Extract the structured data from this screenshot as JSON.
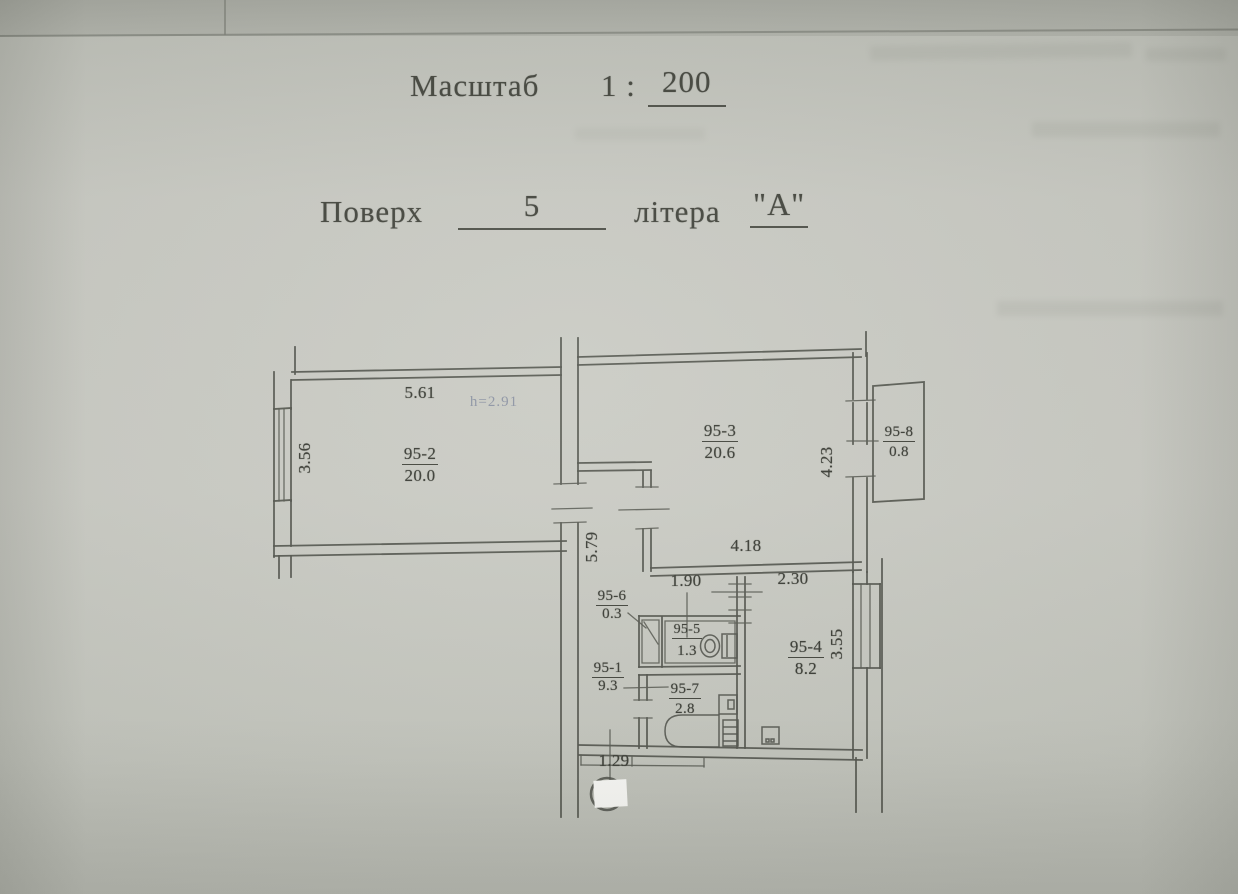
{
  "header": {
    "scale_label": "Масштаб",
    "scale_ratio": "1 :",
    "scale_value": "200",
    "floor_label": "Поверх",
    "floor_value": "5",
    "letter_label": "літера",
    "letter_value": "\"А\""
  },
  "plan": {
    "ceiling_height_note": "h=2.91",
    "rooms": [
      {
        "id": "95-1",
        "area": "9.3"
      },
      {
        "id": "95-2",
        "area": "20.0"
      },
      {
        "id": "95-3",
        "area": "20.6"
      },
      {
        "id": "95-4",
        "area": "8.2"
      },
      {
        "id": "95-5",
        "area": "1.3"
      },
      {
        "id": "95-6",
        "area": "0.3"
      },
      {
        "id": "95-7",
        "area": "2.8"
      },
      {
        "id": "95-8",
        "area": "0.8"
      }
    ],
    "dimensions": {
      "room2_width": "5.61",
      "room2_depth": "3.56",
      "room3_height": "4.23",
      "room3_width": "4.18",
      "corridor_length": "5.79",
      "wc_width": "1.90",
      "kitchen_width": "2.30",
      "kitchen_depth": "3.55",
      "entry_width": "1.29"
    }
  },
  "colors": {
    "paper": "#c8c9c2",
    "paper_edge": "#adafa7",
    "ink": "#54564f",
    "label_ink": "#3c3e37",
    "height_note_ink": "#68738f",
    "redaction_fill": "#fbfbf8"
  }
}
